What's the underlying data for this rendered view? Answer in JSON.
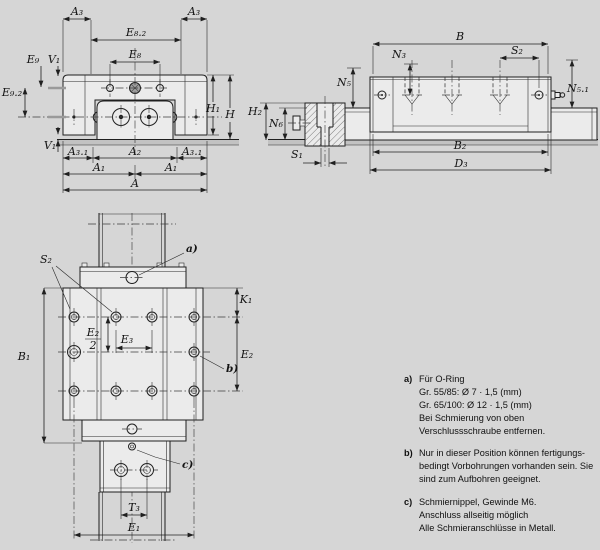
{
  "drawing": {
    "background": "#d6d6d6",
    "part_fill": "#ebebeb",
    "line_color": "#1f1f1f"
  },
  "front_view": {
    "labels": {
      "a3_left": "A₃",
      "a3_right": "A₃",
      "e82": "E₈.₂",
      "e8": "E₈",
      "e9": "E₉",
      "v1_top": "V₁",
      "e92": "E₉.₂",
      "v1_bottom": "V₁",
      "h1": "H₁",
      "h": "H",
      "a31_left": "A₃.₁",
      "a2": "A₂",
      "a31_right": "A₃.₁",
      "a1_left": "A₁",
      "a1_right": "A₁",
      "a": "A"
    }
  },
  "side_view": {
    "labels": {
      "b": "B",
      "n3": "N₃",
      "s2": "S₂",
      "n5": "N₅",
      "n51": "N₅.₁",
      "h2": "H₂",
      "n6": "N₆",
      "s1": "S₁",
      "b2": "B₂",
      "d3": "D₃"
    }
  },
  "top_view": {
    "labels": {
      "s2": "S₂",
      "callout_a": "a)",
      "k1": "K₁",
      "e2": "E₂",
      "callout_b": "b)",
      "b1": "B₁",
      "e2_frac_num": "E₂",
      "e2_frac_den": "2",
      "e3": "E₃",
      "callout_c": "c)",
      "t3": "T₃",
      "e1": "E₁"
    }
  },
  "notes": {
    "a": {
      "tag": "a)",
      "lines": [
        "Für O-Ring",
        "Gr. 55/85: Ø 7 · 1,5 (mm)",
        "Gr. 65/100: Ø 12 · 1,5 (mm)",
        "Bei Schmierung von oben",
        "Verschlussschraube entfernen."
      ]
    },
    "b": {
      "tag": "b)",
      "lines": [
        "Nur in dieser Position können fertigungs-",
        "bedingt Vorbohrungen vorhanden sein. Sie",
        "sind zum Aufbohren geeignet."
      ]
    },
    "c": {
      "tag": "c)",
      "lines": [
        "Schmiernippel, Gewinde M6.",
        "Anschluss allseitig möglich",
        "Alle Schmieranschlüsse in Metall."
      ]
    }
  }
}
